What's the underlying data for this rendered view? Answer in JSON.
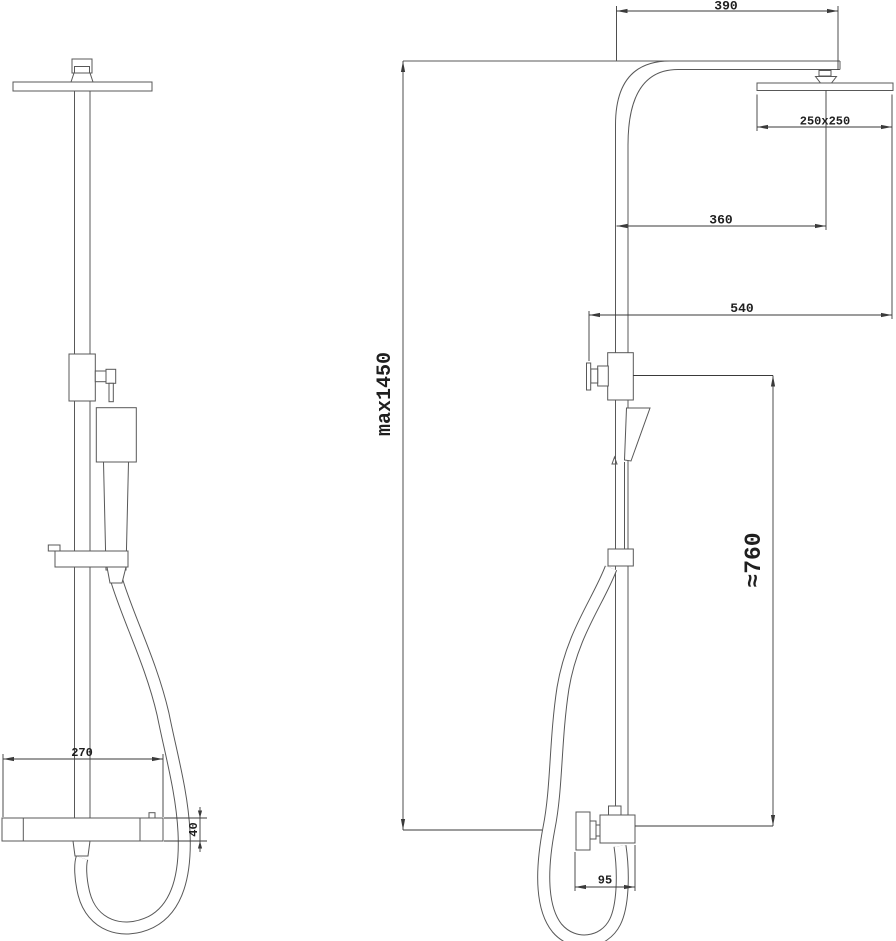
{
  "drawing": {
    "type": "technical-dimension-drawing",
    "subject": "shower column with overhead rain head, hand shower and mixer valve — front and side elevations",
    "colors": {
      "background": "#ffffff",
      "outline": "#585858",
      "dimension_lines": "#3a3a3a",
      "dimension_text": "#1f1f1f"
    },
    "dimensions": {
      "arm_projection": "390",
      "head_size": "250x250",
      "head_center_offset": "360",
      "overall_depth": "540",
      "max_height": "max1450",
      "hose_height": "≈760",
      "outlet_offset": "95",
      "valve_width": "270",
      "valve_height": "40"
    }
  }
}
